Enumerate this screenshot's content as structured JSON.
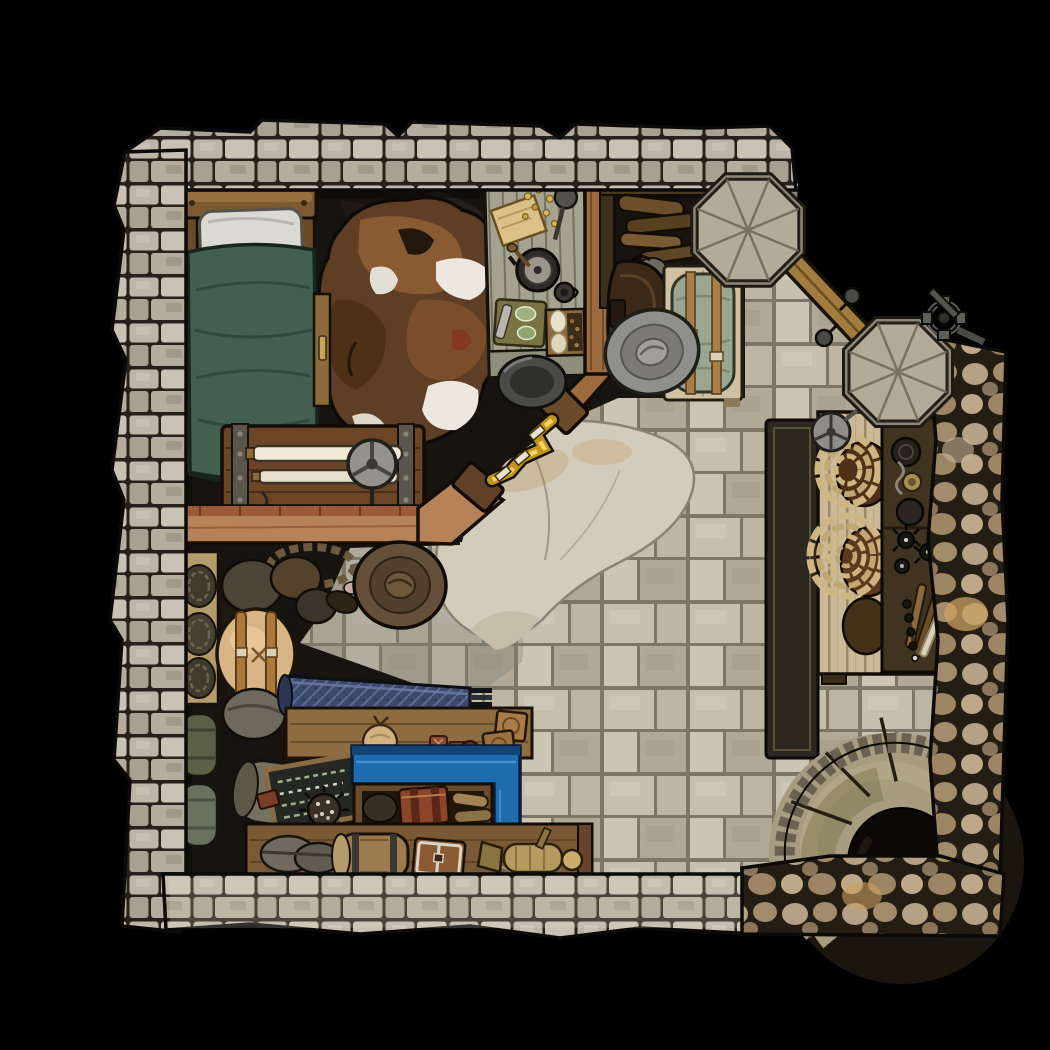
{
  "scene": {
    "type": "top-down fantasy battle map",
    "setting": "stone-walled ranger's quarters with bedroom, supply storage and spiral stairwell",
    "background": "#000000",
    "no_visible_text": true
  },
  "palette": {
    "wall_stone": "#bdb6a8",
    "wall_mortar": "#26221b",
    "rough_cobble": "#b5a286",
    "floor_tile": "#c7bfae",
    "floor_mortar": "#7d7565",
    "dark_floor": "#17130e",
    "slab": "#d4ccba",
    "bed_blanket": "#42604d",
    "pillow": "#dad9d3",
    "wood_dark": "#6b4a2c",
    "wood_light": "#cbb997",
    "railing": "#b5825a",
    "hide_brown": "#6f4526",
    "hide_white": "#ece8df",
    "rope_gold": "#e3b62e",
    "counter_blue": "#1e6cae",
    "fabric_indigo": "#3e4a6c",
    "rope_tan": "#cdb681",
    "metal_grey": "#8e8d86",
    "brass": "#b49a5e"
  },
  "regions": {
    "bedroom": {
      "label": "Bedroom - north-west"
    },
    "main_hall": {
      "label": "Main hall with flagstone floor"
    },
    "storage": {
      "label": "Storage nook - south-west"
    },
    "stairwell": {
      "label": "Spiral stairwell - south-east"
    }
  },
  "objects": {
    "bed": {
      "label": "Bed with green blanket and white pillow"
    },
    "cowhide_rug": {
      "label": "Brown and white cowhide rug"
    },
    "bedside_chest": {
      "label": "Banded chest with scroll rollers and crank wheel"
    },
    "prep_table": {
      "label": "Prep table with pan, parchment, cutting board and bread"
    },
    "bar_railing": {
      "label": "Wooden bar railing"
    },
    "golden_rope": {
      "label": "Golden rope barrier"
    },
    "cauldron": {
      "label": "Metal basin"
    },
    "firewood_stack": {
      "label": "Stacked firewood and stones"
    },
    "saddle": {
      "label": "Leather saddle"
    },
    "grey_hat": {
      "label": "Grey wide-brim hat"
    },
    "bedroll_bench": {
      "label": "Bench with strapped bedroll"
    },
    "north_pillar": {
      "label": "Octagonal stone pillar (north)"
    },
    "east_pillar": {
      "label": "Octagonal stone pillar (east)"
    },
    "timber_beam": {
      "label": "Timber beam between pillars"
    },
    "wall_winch": {
      "label": "Iron winch valve"
    },
    "work_table": {
      "label": "Work table with coiled ropes and pots"
    },
    "tool_rack": {
      "label": "Tool rack with grappling hooks and candles"
    },
    "floor_mat": {
      "label": "Dark floor mat"
    },
    "floor_slab": {
      "label": "Large worn flagstone slab"
    },
    "spiral_stair": {
      "label": "Spiral stone staircase going down"
    },
    "brown_hat": {
      "label": "Brown wide-brim hat on floor"
    },
    "rope_shelf": {
      "label": "Wall shelf with coiled ropes"
    },
    "bedrolls": {
      "label": "Rolled bedrolls"
    },
    "backpacks": {
      "label": "Pile of packs and duffel bags"
    },
    "blue_rug_roll": {
      "label": "Rolled blue patterned rug"
    },
    "supply_shelf": {
      "label": "Supply shelf with pouches, gloves and crates"
    },
    "chalkboard": {
      "label": "Slate tally board"
    },
    "blue_counter": {
      "label": "Blue painted counter"
    },
    "open_crate": {
      "label": "Open crate with strapped chest and bags"
    },
    "display_bench": {
      "label": "Display bench with barrel, chest and brass lamp"
    },
    "barrel": {
      "label": "Wooden barrel"
    },
    "small_chest": {
      "label": "Small banded chest"
    },
    "brass_lamp": {
      "label": "Brass lamp"
    }
  }
}
